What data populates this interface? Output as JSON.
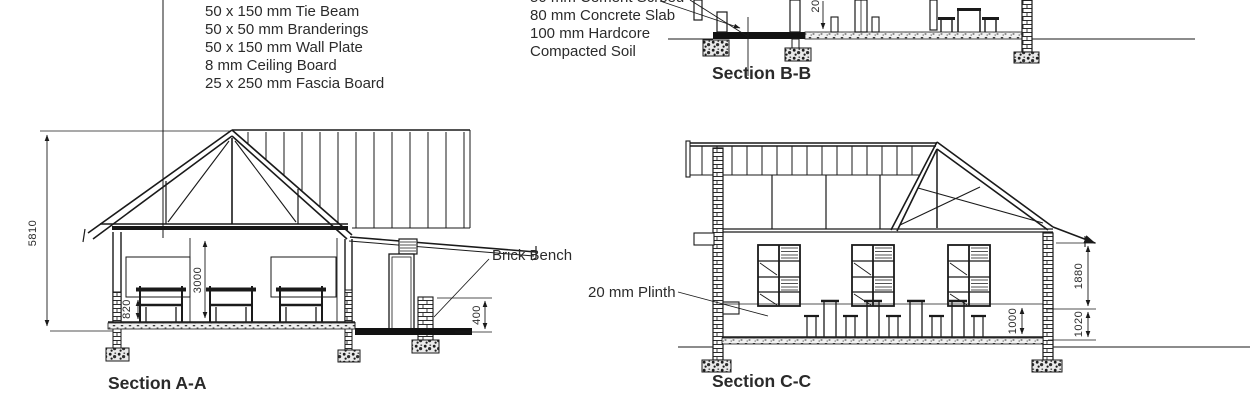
{
  "colors": {
    "line": "#1a1a1a",
    "text": "#2b2b2b"
  },
  "roof_callouts": {
    "items": [
      "50 x 150 mm Tie Beam",
      "50 x 50 mm Branderings",
      "50 x 150 mm Wall Plate",
      "8 mm Ceiling Board",
      "25 x 250 mm Fascia Board"
    ]
  },
  "floor_callouts": {
    "items": [
      "50 mm Cement Screed",
      "80 mm Concrete Slab",
      "100 mm Hardcore",
      "Compacted Soil"
    ]
  },
  "labels": {
    "brick_bench": "Brick Bench",
    "plinth": "20 mm Plinth"
  },
  "sections": {
    "a": {
      "title": "Section A-A",
      "dim_total_height": "5810",
      "dim_ceiling_height": "3000",
      "dim_sill_height": "820",
      "dim_bench_height": "400"
    },
    "b": {
      "title": "Section B-B",
      "dim_partial": "20"
    },
    "c": {
      "title": "Section C-C",
      "dim_roof_height": "1880",
      "dim_lower_wall": "1020",
      "dim_interior": "1000"
    }
  }
}
